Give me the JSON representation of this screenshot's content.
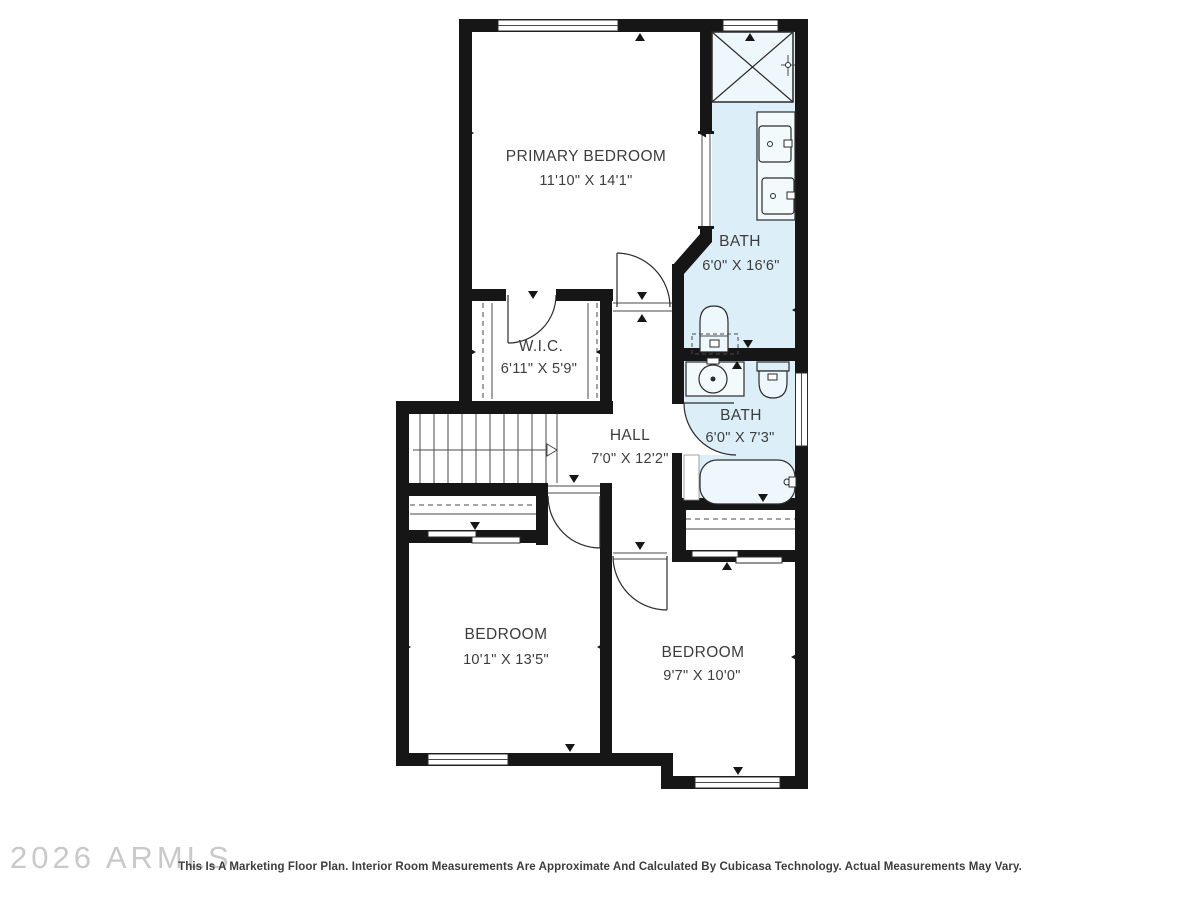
{
  "plan": {
    "rooms": [
      {
        "name": "PRIMARY BEDROOM",
        "dims": "11'10\" X 14'1\""
      },
      {
        "name": "BATH",
        "dims": "6'0\" X 16'6\""
      },
      {
        "name": "W.I.C.",
        "dims": "6'11\" X 5'9\""
      },
      {
        "name": "HALL",
        "dims": "7'0\" X 12'2\""
      },
      {
        "name": "BATH",
        "dims": "6'0\" X 7'3\""
      },
      {
        "name": "BEDROOM",
        "dims": "10'1\" X 13'5\""
      },
      {
        "name": "BEDROOM",
        "dims": "9'7\" X 10'0\""
      }
    ],
    "fixtures": [
      "shower",
      "double-vanity-sinks",
      "toilet",
      "toilet",
      "round-sink",
      "bathtub",
      "staircase",
      "closet-rods"
    ],
    "colors": {
      "wall": "#161616",
      "bath_fill": "#dceef7",
      "label_text": "#3d3d3d",
      "watermark": "#c9c9c9"
    }
  },
  "footer": {
    "watermark": "2026 ARMLS",
    "disclaimer": "This Is A Marketing Floor Plan. Interior Room Measurements Are Approximate And Calculated By Cubicasa Technology. Actual Measurements May Vary."
  }
}
